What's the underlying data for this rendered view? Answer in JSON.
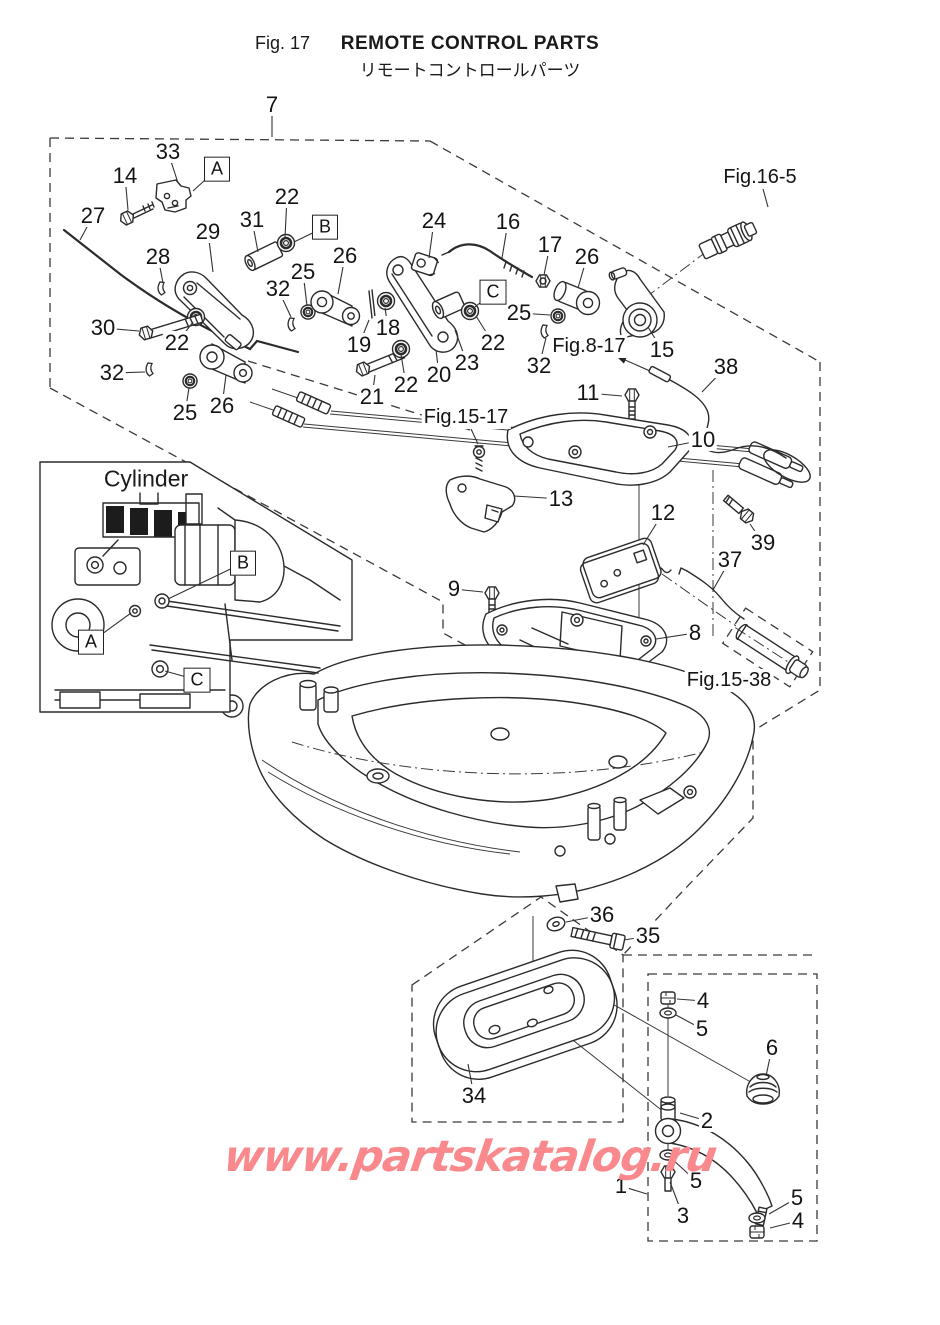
{
  "header": {
    "fig_no": "Fig. 17",
    "title": "REMOTE CONTROL PARTS",
    "subtitle": "リモートコントロールパーツ"
  },
  "watermark": {
    "text": "www.partskatalog.ru",
    "color": "#f9898c"
  },
  "inset": {
    "title": "Cylinder"
  },
  "part_labels": [
    {
      "t": "7",
      "x": 272,
      "y": 105,
      "lx": 272,
      "ly": 137
    },
    {
      "t": "33",
      "x": 168,
      "y": 152,
      "lx": 178,
      "ly": 183
    },
    {
      "t": "14",
      "x": 125,
      "y": 176,
      "lx": 128,
      "ly": 210
    },
    {
      "t": "22",
      "x": 287,
      "y": 197,
      "lx": 285,
      "ly": 237
    },
    {
      "t": "27",
      "x": 93,
      "y": 216,
      "lx": 80,
      "ly": 240
    },
    {
      "t": "31",
      "x": 252,
      "y": 220,
      "lx": 258,
      "ly": 252
    },
    {
      "t": "29",
      "x": 208,
      "y": 232,
      "lx": 213,
      "ly": 272
    },
    {
      "t": "28",
      "x": 158,
      "y": 257,
      "lx": 163,
      "ly": 283
    },
    {
      "t": "26",
      "x": 345,
      "y": 256,
      "lx": 338,
      "ly": 294
    },
    {
      "t": "25",
      "x": 303,
      "y": 272,
      "lx": 307,
      "ly": 306
    },
    {
      "t": "32",
      "x": 278,
      "y": 289,
      "lx": 291,
      "ly": 317
    },
    {
      "t": "30",
      "x": 103,
      "y": 328,
      "lx": 139,
      "ly": 331
    },
    {
      "t": "22",
      "x": 177,
      "y": 343,
      "lx": 193,
      "ly": 322
    },
    {
      "t": "32",
      "x": 112,
      "y": 373,
      "lx": 145,
      "ly": 372
    },
    {
      "t": "25",
      "x": 185,
      "y": 413,
      "lx": 189,
      "ly": 388
    },
    {
      "t": "26",
      "x": 222,
      "y": 406,
      "lx": 226,
      "ly": 375
    },
    {
      "t": "24",
      "x": 434,
      "y": 221,
      "lx": 429,
      "ly": 258
    },
    {
      "t": "16",
      "x": 508,
      "y": 222,
      "lx": 502,
      "ly": 258
    },
    {
      "t": "17",
      "x": 550,
      "y": 245,
      "lx": 544,
      "ly": 275
    },
    {
      "t": "26",
      "x": 587,
      "y": 257,
      "lx": 578,
      "ly": 288
    },
    {
      "t": "25",
      "x": 519,
      "y": 313,
      "lx": 550,
      "ly": 315
    },
    {
      "t": "18",
      "x": 388,
      "y": 328,
      "lx": 385,
      "ly": 308
    },
    {
      "t": "19",
      "x": 359,
      "y": 345,
      "lx": 369,
      "ly": 320
    },
    {
      "t": "23",
      "x": 467,
      "y": 363,
      "lx": 455,
      "ly": 330
    },
    {
      "t": "22",
      "x": 493,
      "y": 343,
      "lx": 476,
      "ly": 316
    },
    {
      "t": "20",
      "x": 439,
      "y": 375,
      "lx": 436,
      "ly": 350
    },
    {
      "t": "22",
      "x": 406,
      "y": 385,
      "lx": 401,
      "ly": 354
    },
    {
      "t": "21",
      "x": 372,
      "y": 397,
      "lx": 375,
      "ly": 375
    },
    {
      "t": "32",
      "x": 539,
      "y": 366,
      "lx": 546,
      "ly": 338
    },
    {
      "t": "15",
      "x": 662,
      "y": 350,
      "lx": 648,
      "ly": 327
    },
    {
      "t": "38",
      "x": 726,
      "y": 367,
      "lx": 702,
      "ly": 392
    },
    {
      "t": "11",
      "x": 588,
      "y": 393,
      "lx": 622,
      "ly": 396
    },
    {
      "t": "10",
      "x": 703,
      "y": 440,
      "lx": 668,
      "ly": 447
    },
    {
      "t": "13",
      "x": 561,
      "y": 499,
      "lx": 514,
      "ly": 496
    },
    {
      "t": "12",
      "x": 663,
      "y": 513,
      "lx": 643,
      "ly": 545
    },
    {
      "t": "39",
      "x": 763,
      "y": 543,
      "lx": 750,
      "ly": 524
    },
    {
      "t": "37",
      "x": 730,
      "y": 560,
      "lx": 713,
      "ly": 590
    },
    {
      "t": "9",
      "x": 454,
      "y": 589,
      "lx": 483,
      "ly": 592
    },
    {
      "t": "8",
      "x": 695,
      "y": 633,
      "lx": 656,
      "ly": 639
    },
    {
      "t": "36",
      "x": 602,
      "y": 915,
      "lx": 566,
      "ly": 922
    },
    {
      "t": "35",
      "x": 648,
      "y": 936,
      "lx": 624,
      "ly": 940
    },
    {
      "t": "34",
      "x": 474,
      "y": 1096,
      "lx": 468,
      "ly": 1064
    },
    {
      "t": "4",
      "x": 703,
      "y": 1001,
      "lx": 677,
      "ly": 999
    },
    {
      "t": "5",
      "x": 702,
      "y": 1029,
      "lx": 676,
      "ly": 1015
    },
    {
      "t": "6",
      "x": 772,
      "y": 1048,
      "lx": 766,
      "ly": 1076
    },
    {
      "t": "2",
      "x": 707,
      "y": 1121,
      "lx": 680,
      "ly": 1113
    },
    {
      "t": "5",
      "x": 696,
      "y": 1181,
      "lx": 671,
      "ly": 1158
    },
    {
      "t": "3",
      "x": 683,
      "y": 1216,
      "lx": 670,
      "ly": 1182
    },
    {
      "t": "5",
      "x": 797,
      "y": 1198,
      "lx": 769,
      "ly": 1214
    },
    {
      "t": "4",
      "x": 798,
      "y": 1221,
      "lx": 770,
      "ly": 1228
    },
    {
      "t": "1",
      "x": 621,
      "y": 1186,
      "lx": 647,
      "ly": 1194
    }
  ],
  "fig_refs": [
    {
      "t": "Fig.16-5",
      "x": 760,
      "y": 178,
      "lx": 768,
      "ly": 207
    },
    {
      "t": "Fig.8-17",
      "x": 589,
      "y": 347,
      "sx": 650,
      "sy": 371,
      "lx": 616,
      "ly": 356,
      "arrow": true
    },
    {
      "t": "Fig.15-17",
      "x": 466,
      "y": 418,
      "lx": 478,
      "ly": 444
    },
    {
      "t": "Fig.15-38",
      "x": 729,
      "y": 681
    }
  ],
  "callouts": [
    {
      "t": "A",
      "x": 217,
      "y": 169,
      "lx": 193,
      "ly": 191
    },
    {
      "t": "B",
      "x": 325,
      "y": 227,
      "lx": 294,
      "ly": 242
    },
    {
      "t": "C",
      "x": 493,
      "y": 292,
      "lx": 475,
      "ly": 307
    },
    {
      "t": "B",
      "x": 243,
      "y": 563,
      "lx": 168,
      "ly": 599
    },
    {
      "t": "A",
      "x": 91,
      "y": 642,
      "lx": 131,
      "ly": 613
    },
    {
      "t": "C",
      "x": 197,
      "y": 680,
      "lx": 165,
      "ly": 671
    }
  ]
}
